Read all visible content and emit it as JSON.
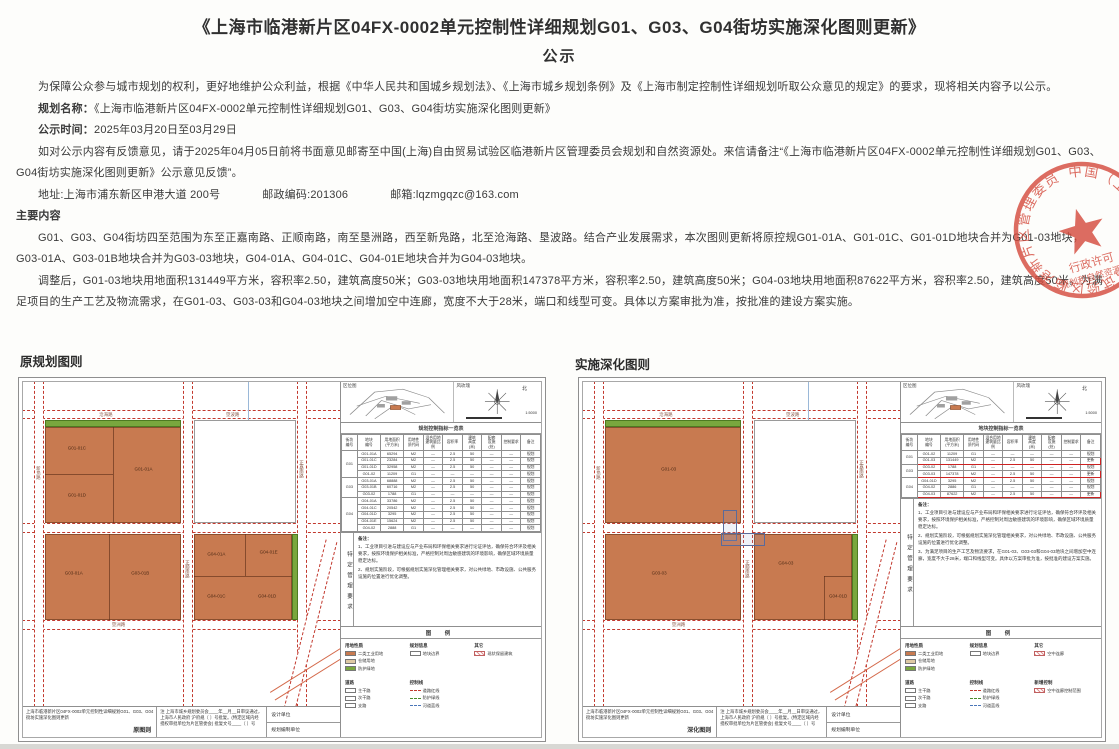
{
  "page": {
    "title": "《上海市临港新片区04FX-0002单元控制性详细规划G01、G03、G04街坊实施深化图则更新》",
    "subtitle": "公示"
  },
  "intro": {
    "p1": "为保障公众参与城市规划的权利，更好地维护公众利益，根据《中华人民共和国城乡规划法》、《上海市城乡规划条例》及《上海市制定控制性详细规划听取公众意见的规定》的要求，现将相关内容予以公示。",
    "plan_name_label": "规划名称：",
    "plan_name": "《上海市临港新片区04FX-0002单元控制性详细规划G01、G03、G04街坊实施深化图则更新》",
    "time_label": "公示时间：",
    "time": "2025年03月20日至03月29日",
    "feedback": "如对公示内容有反馈意见，请于2025年04月05日前将书面意见邮寄至中国(上海)自由贸易试验区临港新片区管理委员会规划和自然资源处。来信请备注“《上海市临港新片区04FX-0002单元控制性详细规划G01、G03、G04街坊实施深化图则更新》公示意见反馈”。",
    "address": "地址:上海市浦东新区申港大道 200号",
    "postcode": "邮政编码:201306",
    "email": "邮箱:lqzmgqzc@163.com"
  },
  "main_content": {
    "heading": "主要内容",
    "p1": "G01、G03、G04街坊四至范围为东至正嘉南路、正顺南路，南至垦洲路，西至新凫路，北至沧海路、垦波路。结合产业发展需求，本次图则更新将原控规G01-01A、G01-01C、G01-01D地块合并为G01-03地块，G03-01A、G03-01B地块合并为G03-03地块，G04-01A、G04-01C、G04-01E地块合并为G04-03地块。",
    "p2": "调整后，G01-03地块用地面积131449平方米，容积率2.50，建筑高度50米；G03-03地块用地面积147378平方米，容积率2.50，建筑高度50米；G04-03地块用地面积87622平方米，容积率2.50，建筑高度50米。为满足项目的生产工艺及物流需求，在G01-03、G03-03和G04-03地块之间增加空中连廊，宽度不大于28米，端口和线型可变。具体以方案审批为准，按批准的建设方案实施。"
  },
  "seal": {
    "ring_text": "中国（上海）自由贸易试验区临港新片区管理委员会",
    "line1": "行政许可",
    "line2": "规划和自然资源章",
    "color": "#d4493b"
  },
  "sections": {
    "left_label": "原规划图则",
    "right_label": "实施深化图则"
  },
  "colors": {
    "industrial": "#c87a50",
    "green_buffer": "#79a73e",
    "road_red": "#c2392e",
    "highlight_red": "#cc2222"
  },
  "map_geometry": {
    "road_w": 3,
    "h_roads": [
      {
        "y": 8.5
      },
      {
        "y": 43.5
      },
      {
        "y": 73.5
      }
    ],
    "v_roads": [
      {
        "x": 3.5
      },
      {
        "x": 50.5
      },
      {
        "x": 86.5
      }
    ],
    "extras": [
      {
        "cls": "road-diag",
        "style": "left:88%;top:48%;width:3%;height:60%;transform:rotate(14deg);"
      },
      {
        "cls": "ramp",
        "style": "left:76%;top:86%;width:36%;height:2.6%;transform:rotate(-32deg);"
      },
      {
        "cls": "river",
        "style": "left:71%;top:0%;width:1%;height:12%;"
      }
    ],
    "road_labels": [
      {
        "t": "沧海路",
        "x": 24,
        "y": 9.2,
        "v": false
      },
      {
        "t": "垦波路",
        "x": 64,
        "y": 9.2,
        "v": false
      },
      {
        "t": "垦洲路",
        "x": 28,
        "y": 74.2,
        "v": false
      },
      {
        "t": "新凫路",
        "x": 3.9,
        "y": 26,
        "v": true
      },
      {
        "t": "正顺南路",
        "x": 50.9,
        "y": 55,
        "v": true
      },
      {
        "t": "正嘉南路",
        "x": 86.9,
        "y": 24,
        "v": true
      }
    ]
  },
  "maps": {
    "left": {
      "inset_label": "区位图",
      "windrose_label": "风玫瑰",
      "north_label": "北",
      "scale_label": "1:5000",
      "table_title": "规划控制指标一览表",
      "table_columns": [
        "街坊\n编号",
        "地块\n编号",
        "用地面积\n(平方米)",
        "用地性\n质代码",
        "混合用地\n建筑量比例",
        "容积率",
        "建筑\n高度\n(米)",
        "配套\n设施\n(处)",
        "控制要求",
        "备注"
      ],
      "table_rows": [
        {
          "g": "G01",
          "hl": false,
          "c": [
            "G01-01A",
            "65294",
            "M2",
            "—",
            "2.5",
            "50",
            "—",
            "—",
            "规划"
          ]
        },
        {
          "g": "G01",
          "hl": false,
          "c": [
            "G01-01C",
            "23284",
            "M2",
            "—",
            "2.5",
            "50",
            "—",
            "—",
            "规划"
          ]
        },
        {
          "g": "G01",
          "hl": false,
          "c": [
            "G01-01D",
            "32958",
            "M2",
            "—",
            "2.5",
            "50",
            "—",
            "—",
            "规划"
          ]
        },
        {
          "g": "G01",
          "hl": false,
          "c": [
            "G01-02",
            "11209",
            "G1",
            "—",
            "—",
            "—",
            "—",
            "—",
            "规划"
          ]
        },
        {
          "g": "G03",
          "hl": false,
          "c": [
            "G03-01A",
            "68888",
            "M2",
            "—",
            "2.5",
            "50",
            "—",
            "—",
            "规划"
          ]
        },
        {
          "g": "G03",
          "hl": false,
          "c": [
            "G03-01B",
            "60716",
            "M2",
            "—",
            "2.5",
            "50",
            "—",
            "—",
            "规划"
          ]
        },
        {
          "g": "G03",
          "hl": false,
          "c": [
            "G03-02",
            "1788",
            "G1",
            "—",
            "—",
            "—",
            "—",
            "—",
            "规划"
          ]
        },
        {
          "g": "G04",
          "hl": false,
          "c": [
            "G04-01A",
            "33786",
            "M2",
            "—",
            "2.5",
            "50",
            "—",
            "—",
            "规划"
          ]
        },
        {
          "g": "G04",
          "hl": false,
          "c": [
            "G04-01C",
            "20542",
            "M2",
            "—",
            "2.5",
            "50",
            "—",
            "—",
            "规划"
          ]
        },
        {
          "g": "G04",
          "hl": false,
          "c": [
            "G04-01D",
            "3295",
            "M2",
            "—",
            "2.5",
            "50",
            "—",
            "—",
            "规划"
          ]
        },
        {
          "g": "G04",
          "hl": false,
          "c": [
            "G04-01E",
            "15624",
            "M2",
            "—",
            "2.5",
            "50",
            "—",
            "—",
            "规划"
          ]
        },
        {
          "g": "G04",
          "hl": false,
          "c": [
            "G04-02",
            "2888",
            "G1",
            "—",
            "—",
            "—",
            "—",
            "—",
            "规划"
          ]
        }
      ],
      "notes_title": "备注：",
      "notes": [
        "1、工业项目引进与建设应与产业布局和环保相关要求进行论证评估，确保符合环评及相关要求，按照环境保护相关标准，严格控制对周边敏感建筑的环境影响，确保区域环境质量稳定达标。",
        "2、规划实施阶段，可根据规划实施深化管理相关要求，对公共绿地、市政设施、公共服务设施的位置进行优化调整。"
      ],
      "vertical_label": "特定管理要求",
      "legend_title": "图  例",
      "legend_groups": [
        {
          "title": "用地性质",
          "items": [
            {
              "c": "#c87a50",
              "t": "二类工业用地"
            },
            {
              "c": "#dec9a3",
              "t": "仓储用地"
            },
            {
              "c": "#79a73e",
              "t": "防护绿地"
            }
          ]
        },
        {
          "title": "规划信息",
          "items": [
            {
              "c": "white",
              "t": "地块边界"
            }
          ]
        },
        {
          "title": "其它",
          "items": [
            {
              "c": "hatch",
              "t": "现状保留建筑"
            }
          ]
        },
        {
          "title": "道路",
          "items": [
            {
              "c": "white",
              "t": "主干路"
            },
            {
              "c": "white",
              "t": "次干路"
            },
            {
              "c": "white",
              "t": "支路"
            }
          ]
        },
        {
          "title": "控制线",
          "items": [
            {
              "c": "line-red",
              "t": "道路红线"
            },
            {
              "c": "line-green",
              "t": "防护绿线"
            },
            {
              "c": "line-blue",
              "t": "河道蓝线"
            }
          ]
        }
      ],
      "titleblock": {
        "project": "上海市临港新片区04FX-0002单元控制性详细规划G01、G03、G04街坊实施深化图则更新",
        "sheet": "原图则",
        "approval_lines": [
          "注  上海市城乡规划委员会____年__月__日审议通过，",
          "上海市人民政府  沪府规〔  〕号批复。(特定区域内经",
          "授权审批单位为片区管委会)  批复文号____〔  〕号"
        ],
        "design_label": "设计单位",
        "org_label": "规划编制单位"
      },
      "parcels": [
        {
          "k": "green",
          "x": 7,
          "y": 11.8,
          "w": 43,
          "h": 2.2
        },
        {
          "k": "block",
          "x": 7,
          "y": 14,
          "w": 43,
          "h": 29.5
        },
        {
          "k": "split-v",
          "x": 28.5,
          "y": 14,
          "h": 29.5
        },
        {
          "k": "split-h",
          "x": 7,
          "y": 28.5,
          "w": 21.5
        },
        {
          "k": "plabel",
          "t": "G01-01C",
          "x": 17,
          "y": 20.5
        },
        {
          "k": "plabel",
          "t": "G01-01A",
          "x": 38,
          "y": 27
        },
        {
          "k": "plabel",
          "t": "G01-01D",
          "x": 17,
          "y": 35
        },
        {
          "k": "outline",
          "x": 54,
          "y": 11.8,
          "w": 32,
          "h": 31.7
        },
        {
          "k": "block",
          "x": 7,
          "y": 47,
          "w": 43,
          "h": 26.5
        },
        {
          "k": "split-v",
          "x": 27,
          "y": 47,
          "h": 26.5
        },
        {
          "k": "plabel",
          "t": "G03-01A",
          "x": 16,
          "y": 59
        },
        {
          "k": "plabel",
          "t": "G03-01B",
          "x": 37,
          "y": 59
        },
        {
          "k": "block",
          "x": 54,
          "y": 47,
          "w": 31,
          "h": 26.5
        },
        {
          "k": "split-v",
          "x": 70,
          "y": 47,
          "h": 13
        },
        {
          "k": "split-h",
          "x": 54,
          "y": 60,
          "w": 31
        },
        {
          "k": "plabel",
          "t": "G04-01A",
          "x": 61,
          "y": 53
        },
        {
          "k": "plabel",
          "t": "G04-01E",
          "x": 77.5,
          "y": 52.5
        },
        {
          "k": "plabel",
          "t": "G04-01C",
          "x": 61,
          "y": 66
        },
        {
          "k": "plabel",
          "t": "G04-01D",
          "x": 77,
          "y": 66
        },
        {
          "k": "green",
          "x": 85,
          "y": 47,
          "w": 1.8,
          "h": 26.5
        }
      ]
    },
    "right": {
      "inset_label": "区位图",
      "windrose_label": "风玫瑰",
      "north_label": "北",
      "scale_label": "1:5000",
      "table_title": "地块控制指标一览表",
      "table_columns": [
        "街坊\n编号",
        "地块\n编号",
        "用地面积\n(平方米)",
        "用地性\n质代码",
        "混合用地\n建筑量比例",
        "容积率",
        "建筑\n高度\n(米)",
        "配套\n设施\n(处)",
        "控制要求",
        "备注"
      ],
      "table_rows": [
        {
          "g": "G01",
          "hl": false,
          "c": [
            "G01-02",
            "11209",
            "G1",
            "—",
            "—",
            "—",
            "—",
            "—",
            "规划"
          ]
        },
        {
          "g": "G01",
          "hl": true,
          "c": [
            "G01-03",
            "131449",
            "M2",
            "—",
            "2.5",
            "50",
            "—",
            "—",
            "更新"
          ]
        },
        {
          "g": "G03",
          "hl": false,
          "c": [
            "G03-02",
            "1788",
            "G1",
            "—",
            "—",
            "—",
            "—",
            "—",
            "规划"
          ]
        },
        {
          "g": "G03",
          "hl": true,
          "c": [
            "G03-03",
            "147378",
            "M2",
            "—",
            "2.5",
            "50",
            "—",
            "—",
            "更新"
          ]
        },
        {
          "g": "G04",
          "hl": false,
          "c": [
            "G04-01D",
            "3295",
            "M2",
            "—",
            "2.5",
            "50",
            "—",
            "—",
            "规划"
          ]
        },
        {
          "g": "G04",
          "hl": false,
          "c": [
            "G04-02",
            "2886",
            "G1",
            "—",
            "—",
            "—",
            "—",
            "—",
            "规划"
          ]
        },
        {
          "g": "G04",
          "hl": true,
          "c": [
            "G04-03",
            "87622",
            "M2",
            "—",
            "2.5",
            "50",
            "—",
            "—",
            "更新"
          ]
        }
      ],
      "notes_title": "备注：",
      "notes": [
        "1、工业项目引进与建设应与产业布局和环保相关要求进行论证评估，确保符合环评及相关要求，按照环境保护相关标准，严格控制对周边敏感建筑的环境影响，确保区域环境质量稳定达标。",
        "2、规划实施阶段，可根据规划实施深化管理相关要求，对公共绿地、市政设施、公共服务设施的位置进行优化调整。",
        "3、为满足项目的生产工艺及物流要求，在G01-03、G03-03和G04-03地块之间增加空中连廊，宽度不大于28米，端口和线型可变。具体以方案审批为准，按批准的建设方案实施。"
      ],
      "vertical_label": "特定管理要求",
      "legend_title": "图  例",
      "legend_groups": [
        {
          "title": "用地性质",
          "items": [
            {
              "c": "#c87a50",
              "t": "二类工业用地"
            },
            {
              "c": "#dec9a3",
              "t": "仓储用地"
            },
            {
              "c": "#79a73e",
              "t": "防护绿地"
            }
          ]
        },
        {
          "title": "规划信息",
          "items": [
            {
              "c": "white",
              "t": "地块边界"
            }
          ]
        },
        {
          "title": "其它",
          "items": [
            {
              "c": "hatch",
              "t": "空中连廊"
            }
          ]
        },
        {
          "title": "道路",
          "items": [
            {
              "c": "white",
              "t": "主干路"
            },
            {
              "c": "white",
              "t": "次干路"
            },
            {
              "c": "white",
              "t": "支路"
            }
          ]
        },
        {
          "title": "控制线",
          "items": [
            {
              "c": "line-red",
              "t": "道路红线"
            },
            {
              "c": "line-green",
              "t": "防护绿线"
            },
            {
              "c": "line-blue",
              "t": "河道蓝线"
            }
          ]
        },
        {
          "title": "新增控制",
          "items": [
            {
              "c": "hatch",
              "t": "空中连廊控制范围"
            }
          ]
        }
      ],
      "titleblock": {
        "project": "上海市临港新片区04FX-0002单元控制性详细规划G01、G03、G04街坊实施深化图则更新",
        "sheet": "深化图则",
        "approval_lines": [
          "注  上海市城乡规划委员会____年__月__日审议通过，",
          "上海市人民政府  沪府规〔  〕号批复。(特定区域内经",
          "授权审批单位为片区管委会)  批复文号____〔  〕号"
        ],
        "design_label": "设计单位",
        "org_label": "规划编制单位"
      },
      "parcels": [
        {
          "k": "green",
          "x": 7,
          "y": 11.8,
          "w": 43,
          "h": 2.2
        },
        {
          "k": "block",
          "x": 7,
          "y": 14,
          "w": 43,
          "h": 29.5
        },
        {
          "k": "plabel",
          "t": "G01-03",
          "x": 27,
          "y": 27
        },
        {
          "k": "outline",
          "x": 54,
          "y": 11.8,
          "w": 32,
          "h": 31.7
        },
        {
          "k": "block",
          "x": 7,
          "y": 47,
          "w": 43,
          "h": 26.5
        },
        {
          "k": "plabel",
          "t": "G03-03",
          "x": 24,
          "y": 59
        },
        {
          "k": "block",
          "x": 54,
          "y": 47,
          "w": 31,
          "h": 26.5
        },
        {
          "k": "split-v",
          "x": 76,
          "y": 60,
          "h": 13.5
        },
        {
          "k": "split-h",
          "x": 76,
          "y": 60,
          "w": 9
        },
        {
          "k": "plabel",
          "t": "G04-03",
          "x": 64,
          "y": 56
        },
        {
          "k": "plabel",
          "t": "G04-01D",
          "x": 80.5,
          "y": 66
        },
        {
          "k": "green",
          "x": 85,
          "y": 47,
          "w": 1.8,
          "h": 26.5
        },
        {
          "k": "corridor",
          "x": 44.2,
          "y": 39.5,
          "w": 4.5,
          "h": 9.5
        },
        {
          "k": "corridor",
          "x": 43.5,
          "y": 46.5,
          "w": 14,
          "h": 4
        }
      ]
    }
  }
}
